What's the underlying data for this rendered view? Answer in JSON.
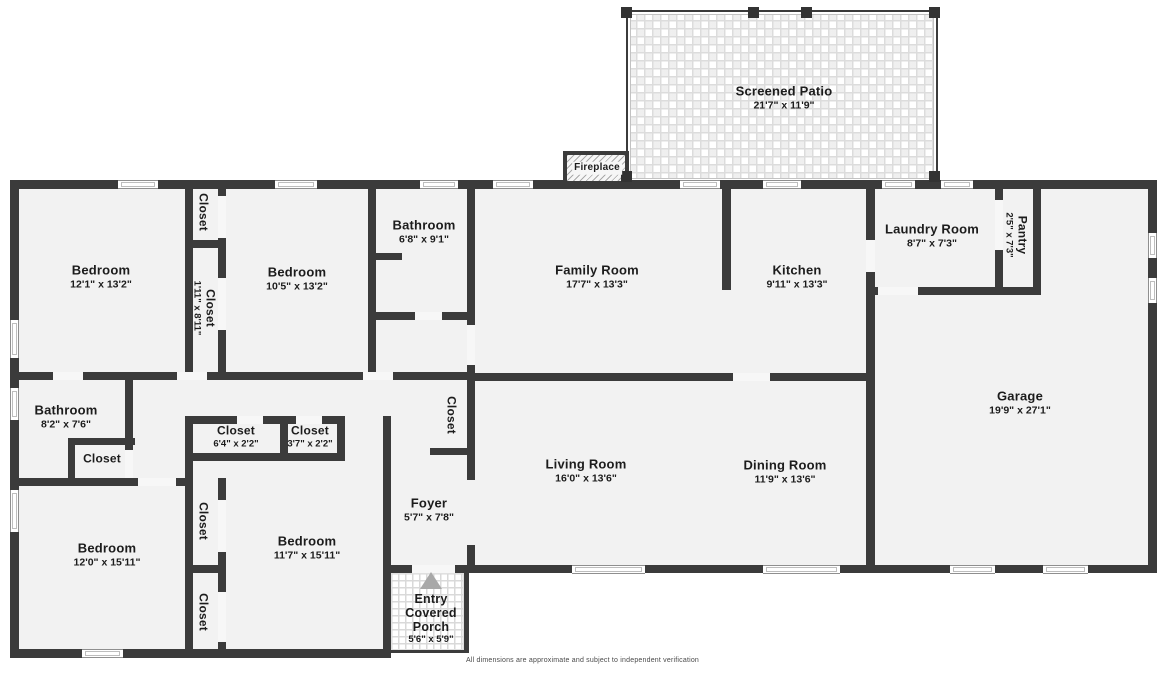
{
  "document": {
    "type": "residential-floor-plan"
  },
  "colors": {
    "wall": "#3b3b3b",
    "floor": "#f2f2f2",
    "tile_line": "#dcdcdc",
    "entry_arrow": "#a8a8a8",
    "background": "#ffffff"
  },
  "footer": {
    "disclaimer": "All dimensions are approximate and subject to independent verification"
  },
  "rooms": [
    {
      "id": "screened-patio",
      "name": "Screened Patio",
      "dims": "21'7\" x 11'9\"",
      "x": 784,
      "y": 98
    },
    {
      "id": "fireplace",
      "name": "Fireplace",
      "x": 597,
      "y": 168,
      "cls": "fireplace-label"
    },
    {
      "id": "bedroom-1",
      "name": "Bedroom",
      "dims": "12'1\" x 13'2\"",
      "x": 101,
      "y": 277
    },
    {
      "id": "closet-1",
      "name": "Closet",
      "x": 203,
      "y": 212,
      "v": true,
      "cls": "small"
    },
    {
      "id": "closet-2",
      "name": "Closet",
      "dims": "1'11\" x 8'11\"",
      "x": 204,
      "y": 308,
      "v": true,
      "cls": "small"
    },
    {
      "id": "bedroom-2",
      "name": "Bedroom",
      "dims": "10'5\" x 13'2\"",
      "x": 297,
      "y": 279
    },
    {
      "id": "bathroom-1",
      "name": "Bathroom",
      "dims": "6'8\" x 9'1\"",
      "x": 424,
      "y": 232
    },
    {
      "id": "family-room",
      "name": "Family Room",
      "dims": "17'7\" x 13'3\"",
      "x": 597,
      "y": 277
    },
    {
      "id": "kitchen",
      "name": "Kitchen",
      "dims": "9'11\" x 13'3\"",
      "x": 797,
      "y": 277
    },
    {
      "id": "laundry-room",
      "name": "Laundry Room",
      "dims": "8'7\" x 7'3\"",
      "x": 932,
      "y": 236
    },
    {
      "id": "pantry",
      "name": "Pantry",
      "dims": "2'5\" x 7'3\"",
      "x": 1016,
      "y": 235,
      "v": true,
      "cls": "small"
    },
    {
      "id": "garage",
      "name": "Garage",
      "dims": "19'9\" x 27'1\"",
      "x": 1020,
      "y": 403
    },
    {
      "id": "living-room",
      "name": "Living Room",
      "dims": "16'0\" x 13'6\"",
      "x": 586,
      "y": 471
    },
    {
      "id": "dining-room",
      "name": "Dining Room",
      "dims": "11'9\" x 13'6\"",
      "x": 785,
      "y": 472
    },
    {
      "id": "closet-3",
      "name": "Closet",
      "x": 451,
      "y": 415,
      "v": true,
      "cls": "small"
    },
    {
      "id": "bathroom-2",
      "name": "Bathroom",
      "dims": "8'2\" x 7'6\"",
      "x": 66,
      "y": 417
    },
    {
      "id": "closet-4",
      "name": "Closet",
      "x": 102,
      "y": 459,
      "cls": "small"
    },
    {
      "id": "closet-5",
      "name": "Closet",
      "dims": "6'4\" x 2'2\"",
      "x": 236,
      "y": 437,
      "cls": "small"
    },
    {
      "id": "closet-6",
      "name": "Closet",
      "dims": "3'7\" x 2'2\"",
      "x": 310,
      "y": 437,
      "cls": "small"
    },
    {
      "id": "bedroom-3",
      "name": "Bedroom",
      "dims": "12'0\" x 15'11\"",
      "x": 107,
      "y": 555
    },
    {
      "id": "closet-7",
      "name": "Closet",
      "x": 203,
      "y": 521,
      "v": true,
      "cls": "small"
    },
    {
      "id": "closet-8",
      "name": "Closet",
      "x": 203,
      "y": 612,
      "v": true,
      "cls": "small"
    },
    {
      "id": "bedroom-4",
      "name": "Bedroom",
      "dims": "11'7\" x 15'11\"",
      "x": 307,
      "y": 548
    },
    {
      "id": "foyer",
      "name": "Foyer",
      "dims": "5'7\" x 7'8\"",
      "x": 429,
      "y": 510
    },
    {
      "id": "entry",
      "name": "Entry",
      "x": 431,
      "y": 600,
      "cls": "porchlbl"
    },
    {
      "id": "covered-porch",
      "name": "Covered Porch",
      "dims": "5'6\" x 5'9\"",
      "x": 431,
      "y": 626,
      "cls": "porchlbl wrap",
      "w": 66
    }
  ]
}
